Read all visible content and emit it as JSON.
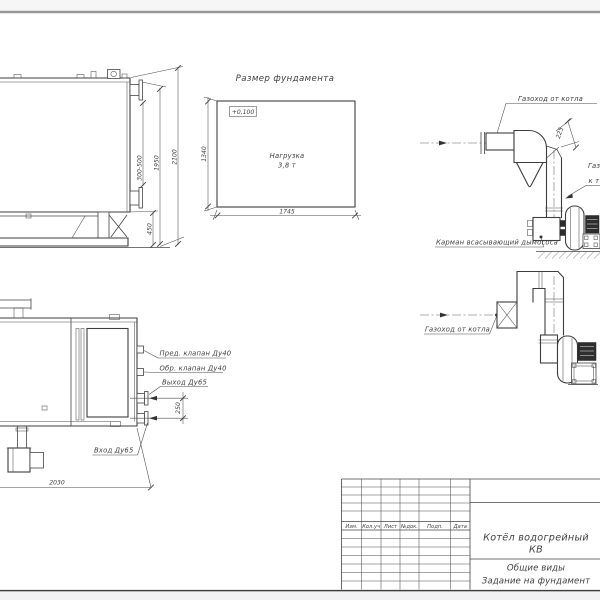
{
  "drawing": {
    "side_view": {
      "dim_nozzle_range": "300-500",
      "dim_upper": "1950",
      "dim_total_height": "2100",
      "dim_base_height": "450"
    },
    "foundation": {
      "title": "Размер фундамента",
      "elevation_mark": "+0,100",
      "load_line1": "Нагрузка",
      "load_line2": "3,8 т",
      "dim_depth": "1340",
      "dim_width": "1745"
    },
    "gas_duct_upper": {
      "label_from_boiler": "Газоход от котла",
      "dim_offset": "225",
      "label_to_stack_line1": "Газ",
      "label_to_stack_line2": "к т",
      "label_pocket": "Карман всасывающий дымососа"
    },
    "gas_duct_lower": {
      "label_from_boiler": "Газоход от котла"
    },
    "plan_view": {
      "label_safety_valve": "Пред. клапан Ду40",
      "label_check_valve": "Обр. клапан Ду40",
      "label_outlet": "Выход Ду65",
      "label_inlet": "Вход Ду65",
      "dim_nozzle_spacing": "250",
      "dim_length": "2030"
    },
    "title_block": {
      "headers": [
        "Изм.",
        "Кол.уч",
        "Лист",
        "№док.",
        "Подп.",
        "Дата"
      ],
      "product_name_line1": "Котёл водогрейный",
      "product_name_line2": "КВ",
      "sheet_name_line1": "Общие виды",
      "sheet_name_line2": "Задание на фундамент"
    }
  }
}
